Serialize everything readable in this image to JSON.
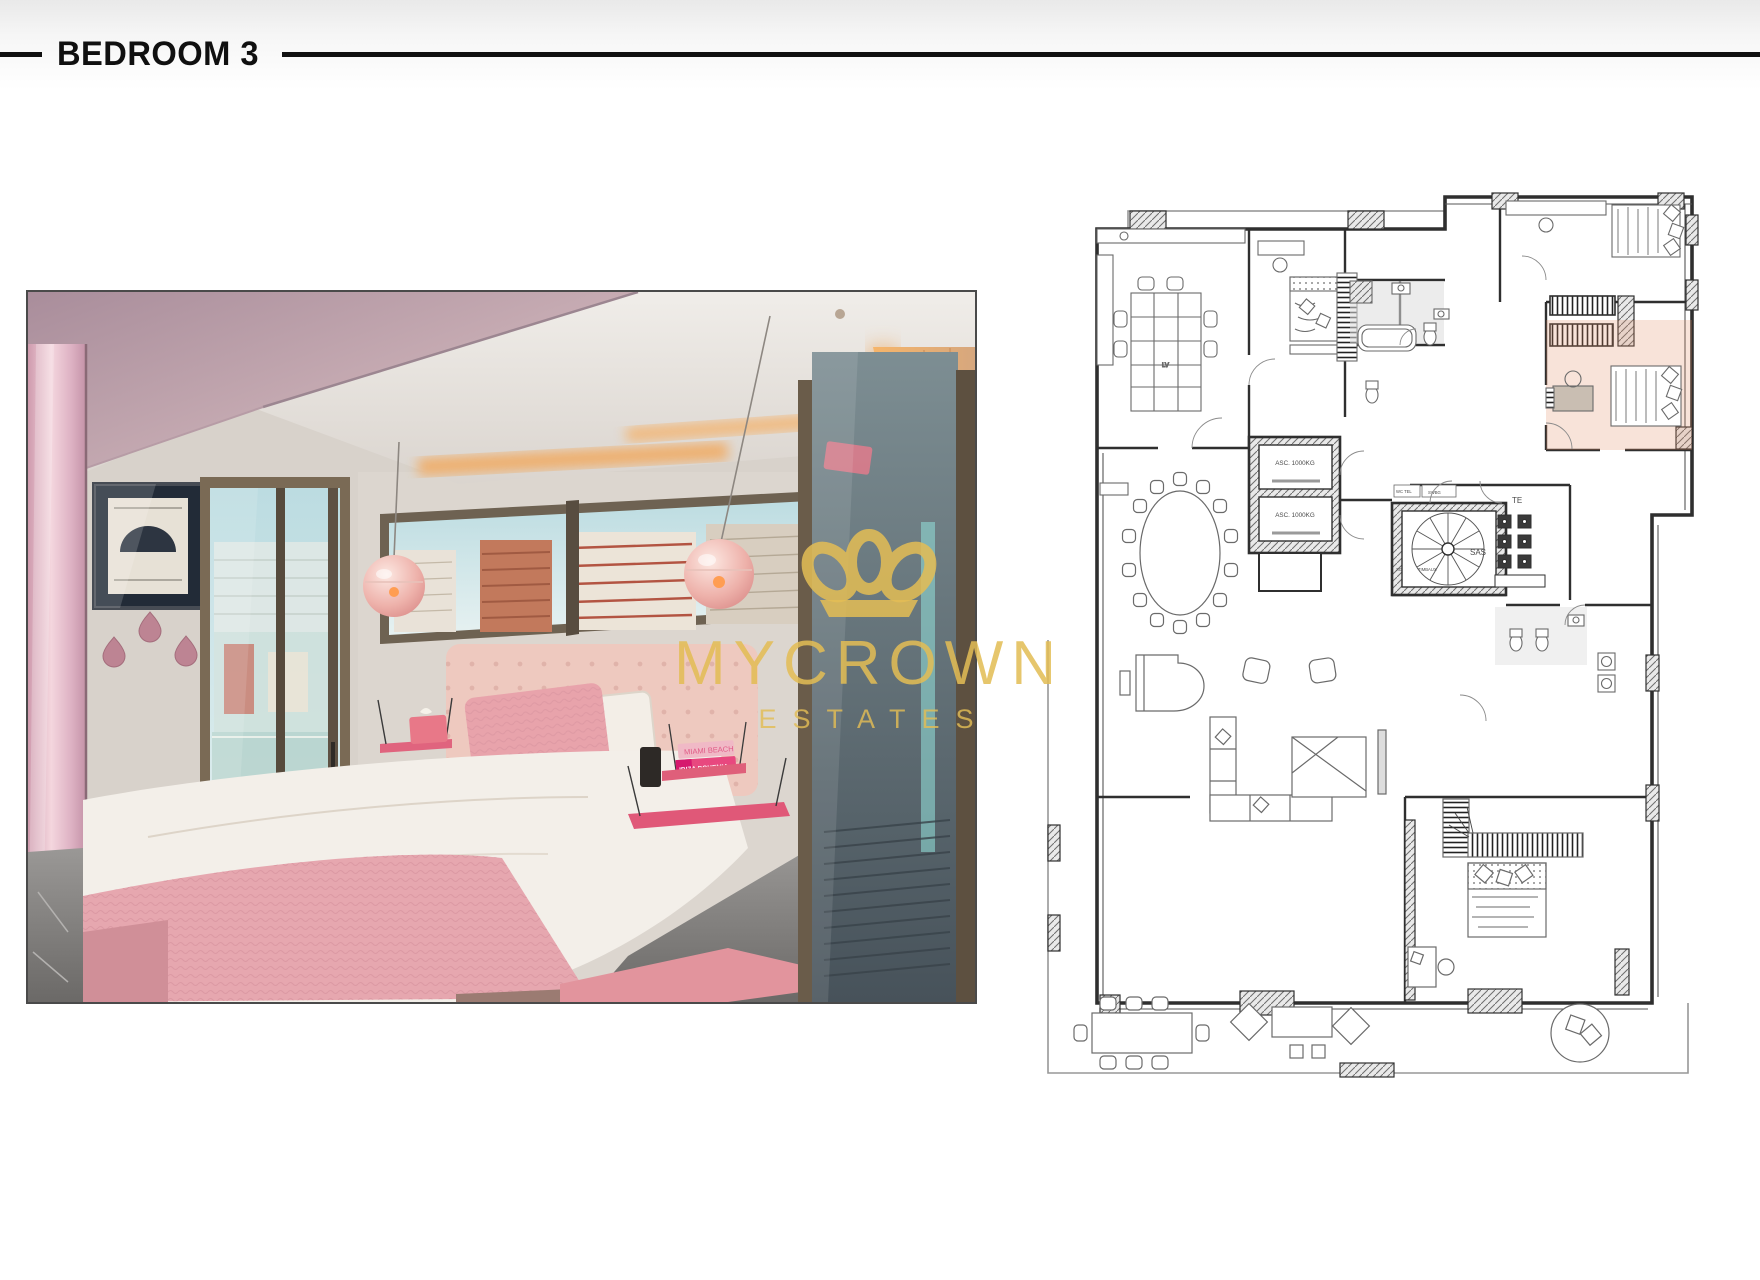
{
  "page": {
    "background": "#ffffff",
    "top_band": "#ebebeb"
  },
  "header": {
    "title": "BEDROOM 3",
    "text_color": "#101010",
    "rule_color": "#101010"
  },
  "watermark": {
    "brand": "MYCROWN",
    "suffix": "ESTATES",
    "color": "#e3bd55",
    "icon": "crown-icon"
  },
  "photo": {
    "description": "bedroom-3-interior-photo",
    "shelf_books": {
      "book1": "MIAMI BEACH",
      "book2": "IBIZA BOHEMIA"
    },
    "palette": {
      "wall": "#d8d2cb",
      "ceiling_mauve": "#bb9da8",
      "wardrobe_pink": "#ecc9d3",
      "balcony_turf": "#3f9f35",
      "bed_duvet": "#f3efe9",
      "throw_pink": "#e6a7af",
      "shelf_pink": "#e0607c",
      "rug_pink": "#e2949d",
      "cove_glow": "#f2a85c",
      "frame_bronze": "#7a6a55"
    }
  },
  "floor_plan": {
    "description": "apartment-floor-plan",
    "line_color": "#2f2f2f",
    "highlight": {
      "room": "Bedroom 3",
      "color": "#e08a5f",
      "opacity": 0.24
    },
    "labels": {
      "elevator_1": "ASC. 1000KG",
      "elevator_2": "ASC. 1000KG",
      "sas": "SAS",
      "te": "TE",
      "lv": "LV",
      "wc_tel": "WC TEL",
      "swbg": "SWBG",
      "sg": "SG",
      "timbaux": "TIMBAUX"
    }
  }
}
